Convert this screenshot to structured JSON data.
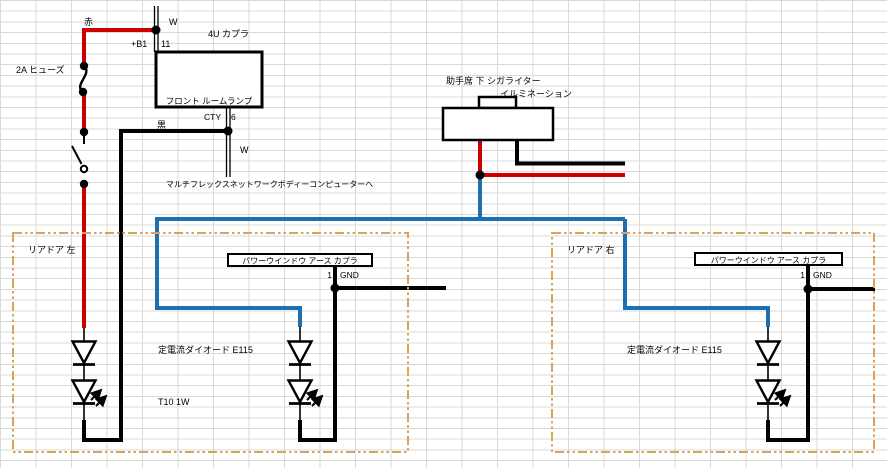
{
  "colors": {
    "wire_red": "#cc0000",
    "wire_blue": "#1c6fb0",
    "wire_black": "#000000",
    "door_dash_orange": "#dfa05c",
    "grid_line": "#d9d9d9"
  },
  "power_circuit": {
    "red_wire_label": "赤",
    "white_wire_label_top": "W",
    "fuse_label": "2A ヒューズ",
    "coupler_label": "4U カプラ",
    "pin_b1_label": "+B1",
    "pin_11_label": "11",
    "room_lamp_box_label": "フロント ルームランプ",
    "connector_cty_label": "CTY",
    "pin_6_label": "6",
    "black_wire_label": "黒",
    "white_wire_label_bottom": "W",
    "multiplex_note": "マルチフレックスネットワークボディーコンピューターへ"
  },
  "cigar_lighter": {
    "title_line1": "助手席 下 シガライター",
    "title_line2": "イルミネーション"
  },
  "door_left": {
    "title": "リアドア 左",
    "coupler_label": "パワーウインドウ アース カプラ",
    "pin_1_label": "1",
    "gnd_label": "GND",
    "diode_note": "定電流ダイオード E115",
    "bulb_note": "T10 1W"
  },
  "door_right": {
    "title": "リアドア 右",
    "coupler_label": "パワーウインドウ アース カプラ",
    "pin_1_label": "1",
    "gnd_label": "GND",
    "diode_note": "定電流ダイオード E115"
  }
}
